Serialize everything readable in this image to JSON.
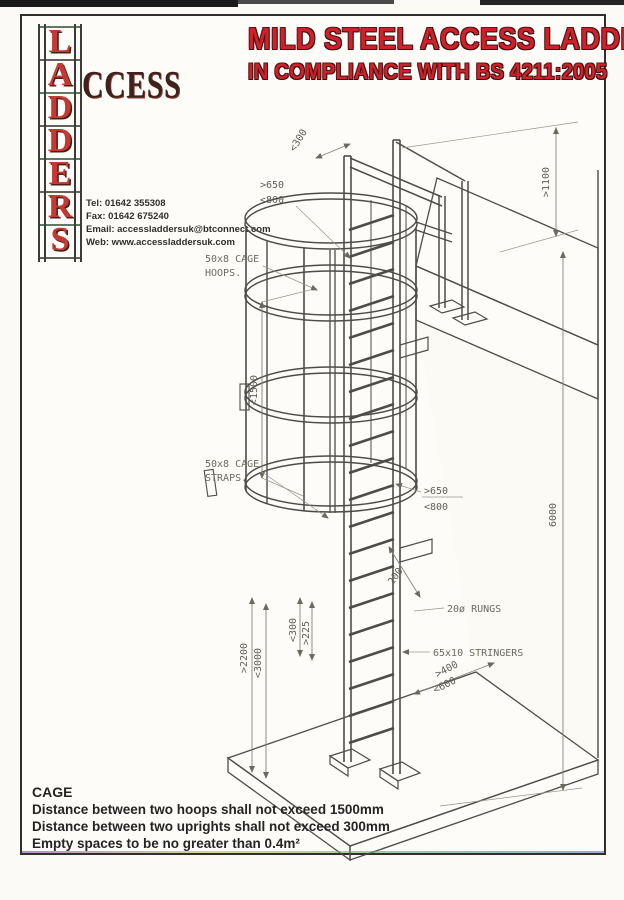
{
  "header": {
    "title_line1": "MILD STEEL ACCESS LADDER",
    "title_line2": "IN COMPLIANCE WITH BS 4211:2005",
    "title_color": "#d0202a"
  },
  "logo": {
    "letters": [
      "L",
      "A",
      "D",
      "D",
      "E",
      "R",
      "S"
    ],
    "suffix": "CCESS",
    "letter_color": "#c43a33",
    "contact_lines": [
      "Tel: 01642 355308",
      "Fax: 01642 675240",
      "Email: accessladdersuk@btconnect.com",
      "Web: www.accessladdersuk.com"
    ]
  },
  "drawing": {
    "labels": {
      "hoops_line1": "50x8 CAGE",
      "hoops_line2": "HOOPS.",
      "straps_line1": "50x8 CAGE",
      "straps_line2": "STRAPS.",
      "rungs": "20ø RUNGS",
      "stringers": "65x10 STRINGERS"
    },
    "dimensions": {
      "top_width": "<300",
      "hoop_front_min": ">650",
      "hoop_front_max": "<800",
      "hoop_spacing_max": "<1500",
      "cage_dia_min": ">650",
      "cage_dia_max": "<800",
      "extension_height": ">1100",
      "wall_height": "6000",
      "bracket_offset": "200",
      "rung_pitch_max": "<300",
      "rung_pitch_min": ">225",
      "lower_run_min": ">2200",
      "lower_run_max": "<3000",
      "base_clear_min": ">400",
      "base_clear_max": "<600"
    }
  },
  "notes": {
    "heading": "CAGE",
    "lines": [
      "Distance between two hoops shall not exceed 1500mm",
      "Distance between two uprights shall not exceed 300mm",
      "Empty spaces to be no greater than 0.4m²"
    ]
  }
}
